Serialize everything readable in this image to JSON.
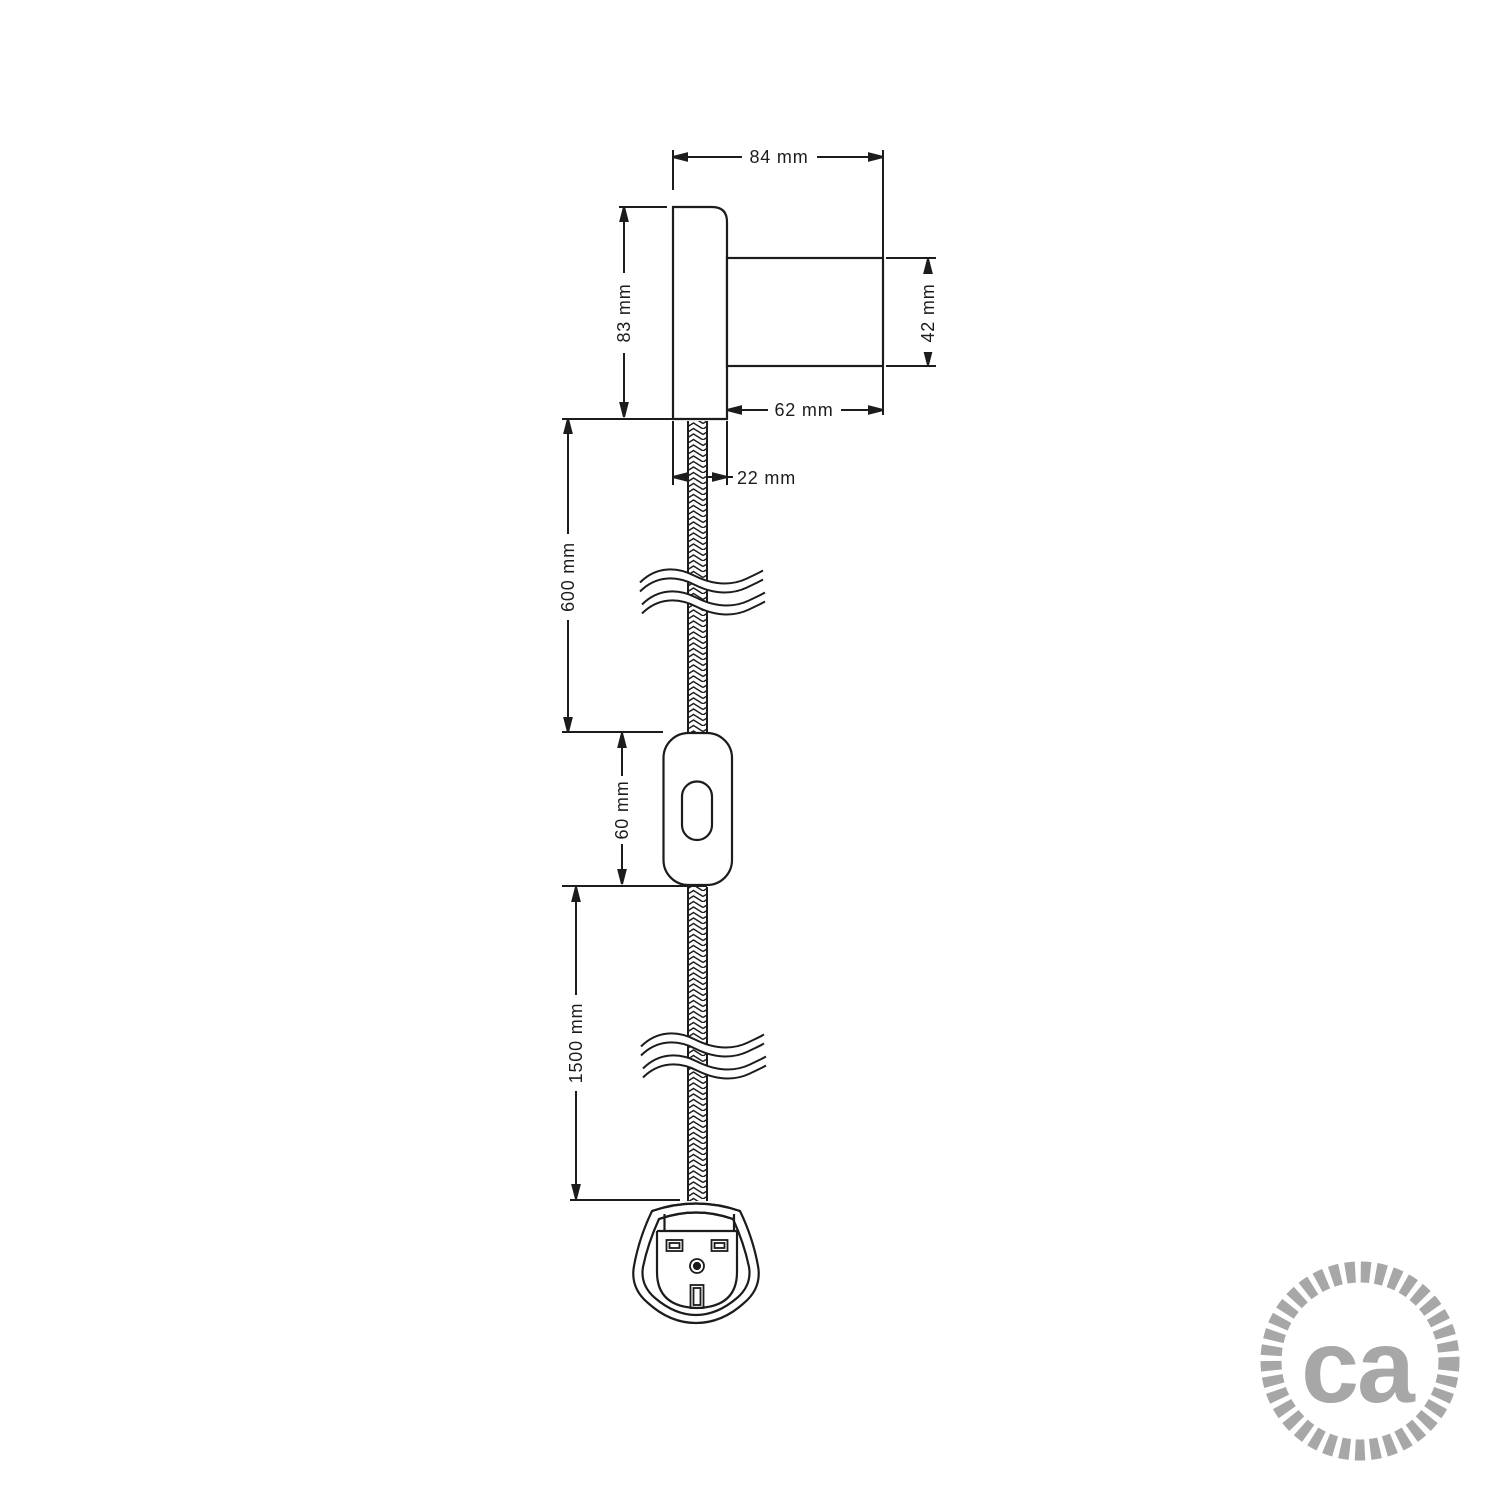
{
  "page": {
    "background": "#ffffff"
  },
  "drawing": {
    "line_color": "#1c1c1c",
    "labels": {
      "total_depth": "84 mm",
      "plate_height": "83 mm",
      "body_diameter": "42 mm",
      "body_length": "62 mm",
      "plate_thickness": "22 mm",
      "upper_cable_length": "600 mm",
      "switch_length": "60 mm",
      "lower_cable_length": "1500 mm"
    }
  },
  "logo": {
    "text": "ca",
    "color": "#a7a7a7"
  }
}
